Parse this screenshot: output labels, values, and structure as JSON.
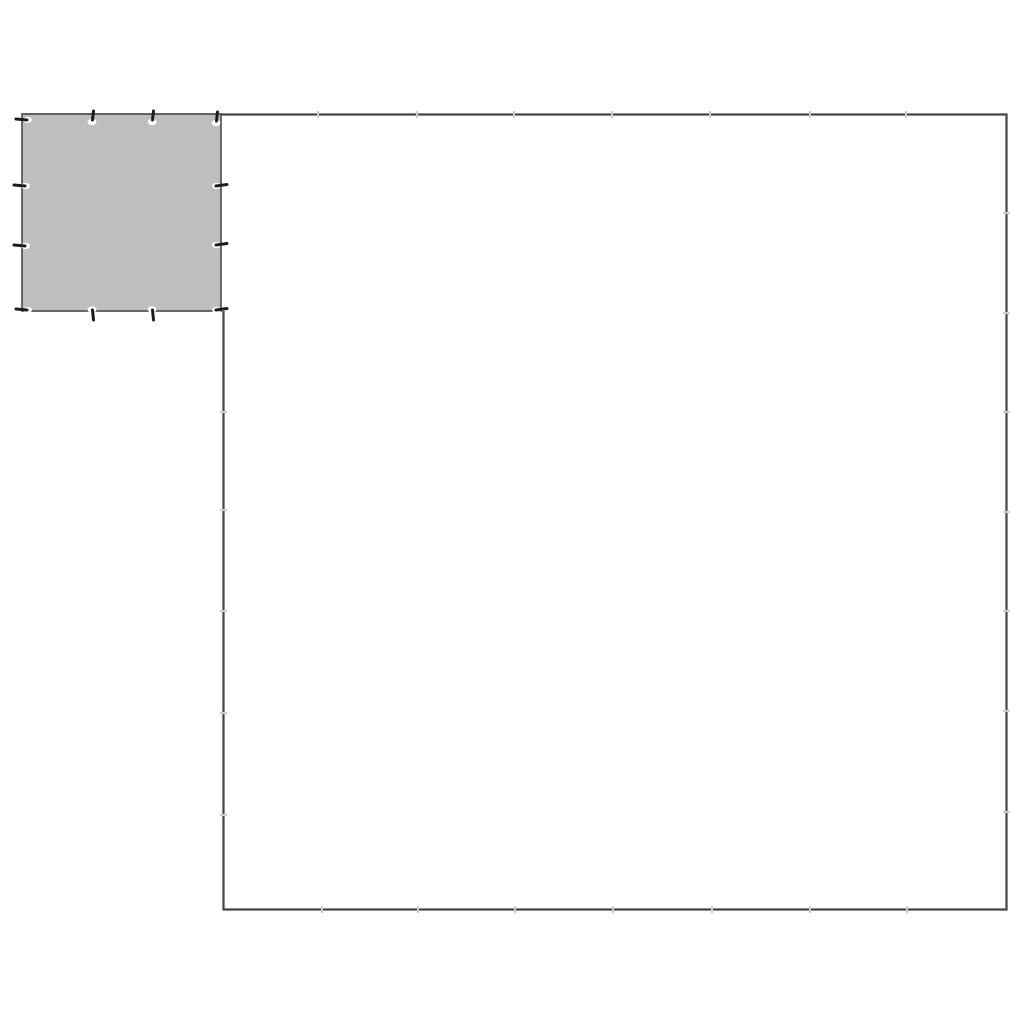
{
  "page": {
    "background_color": "#ffffff",
    "width": 1024,
    "height": 1024
  },
  "colors": {
    "tarp_fill": "#bebebe",
    "tarp_stroke": "#4a4a4a",
    "outline_stroke": "#434343",
    "seam_tick": "#cdcdcd",
    "grommet_fill": "#ffffff",
    "grommet_pin": "#1c1c1c"
  },
  "diagram": {
    "semantic": "tarpaulin-size-comparison-diagram",
    "small_tarp": {
      "x": 22,
      "y": 114,
      "width": 199,
      "height": 197,
      "stroke_width": 1.6
    },
    "large_tarp_outline": {
      "points": [
        [
          22,
          114.5
        ],
        [
          1006.5,
          114.5
        ],
        [
          1006.5,
          909.5
        ],
        [
          223.5,
          909.5
        ],
        [
          223.5,
          311
        ]
      ],
      "stroke_width": 2.2
    },
    "seam_ticks": {
      "length": 7,
      "width": 2.2,
      "top_edge": {
        "y": 114.5,
        "xs": [
          318,
          417,
          514,
          612,
          710,
          810,
          906
        ]
      },
      "right_edge": {
        "x": 1006.5,
        "ys": [
          213,
          313,
          412,
          512,
          611,
          711,
          812
        ]
      },
      "bottom_edge": {
        "y": 909.5,
        "xs": [
          322,
          418,
          515,
          613,
          712,
          810,
          907
        ]
      },
      "inner_left_edge": {
        "x": 223.5,
        "ys": [
          412,
          510,
          611,
          713,
          815
        ]
      }
    },
    "grommets": [
      {
        "x": 25,
        "y": 120,
        "dir": "left"
      },
      {
        "x": 92,
        "y": 119,
        "dir": "up"
      },
      {
        "x": 152,
        "y": 119,
        "dir": "up"
      },
      {
        "x": 216,
        "y": 120,
        "dir": "up"
      },
      {
        "x": 23,
        "y": 186,
        "dir": "left"
      },
      {
        "x": 23,
        "y": 246,
        "dir": "left"
      },
      {
        "x": 218,
        "y": 186,
        "dir": "right"
      },
      {
        "x": 218,
        "y": 245,
        "dir": "right"
      },
      {
        "x": 25,
        "y": 310,
        "dir": "left"
      },
      {
        "x": 92,
        "y": 311,
        "dir": "down"
      },
      {
        "x": 152,
        "y": 311,
        "dir": "down"
      },
      {
        "x": 218,
        "y": 310,
        "dir": "right"
      }
    ]
  }
}
